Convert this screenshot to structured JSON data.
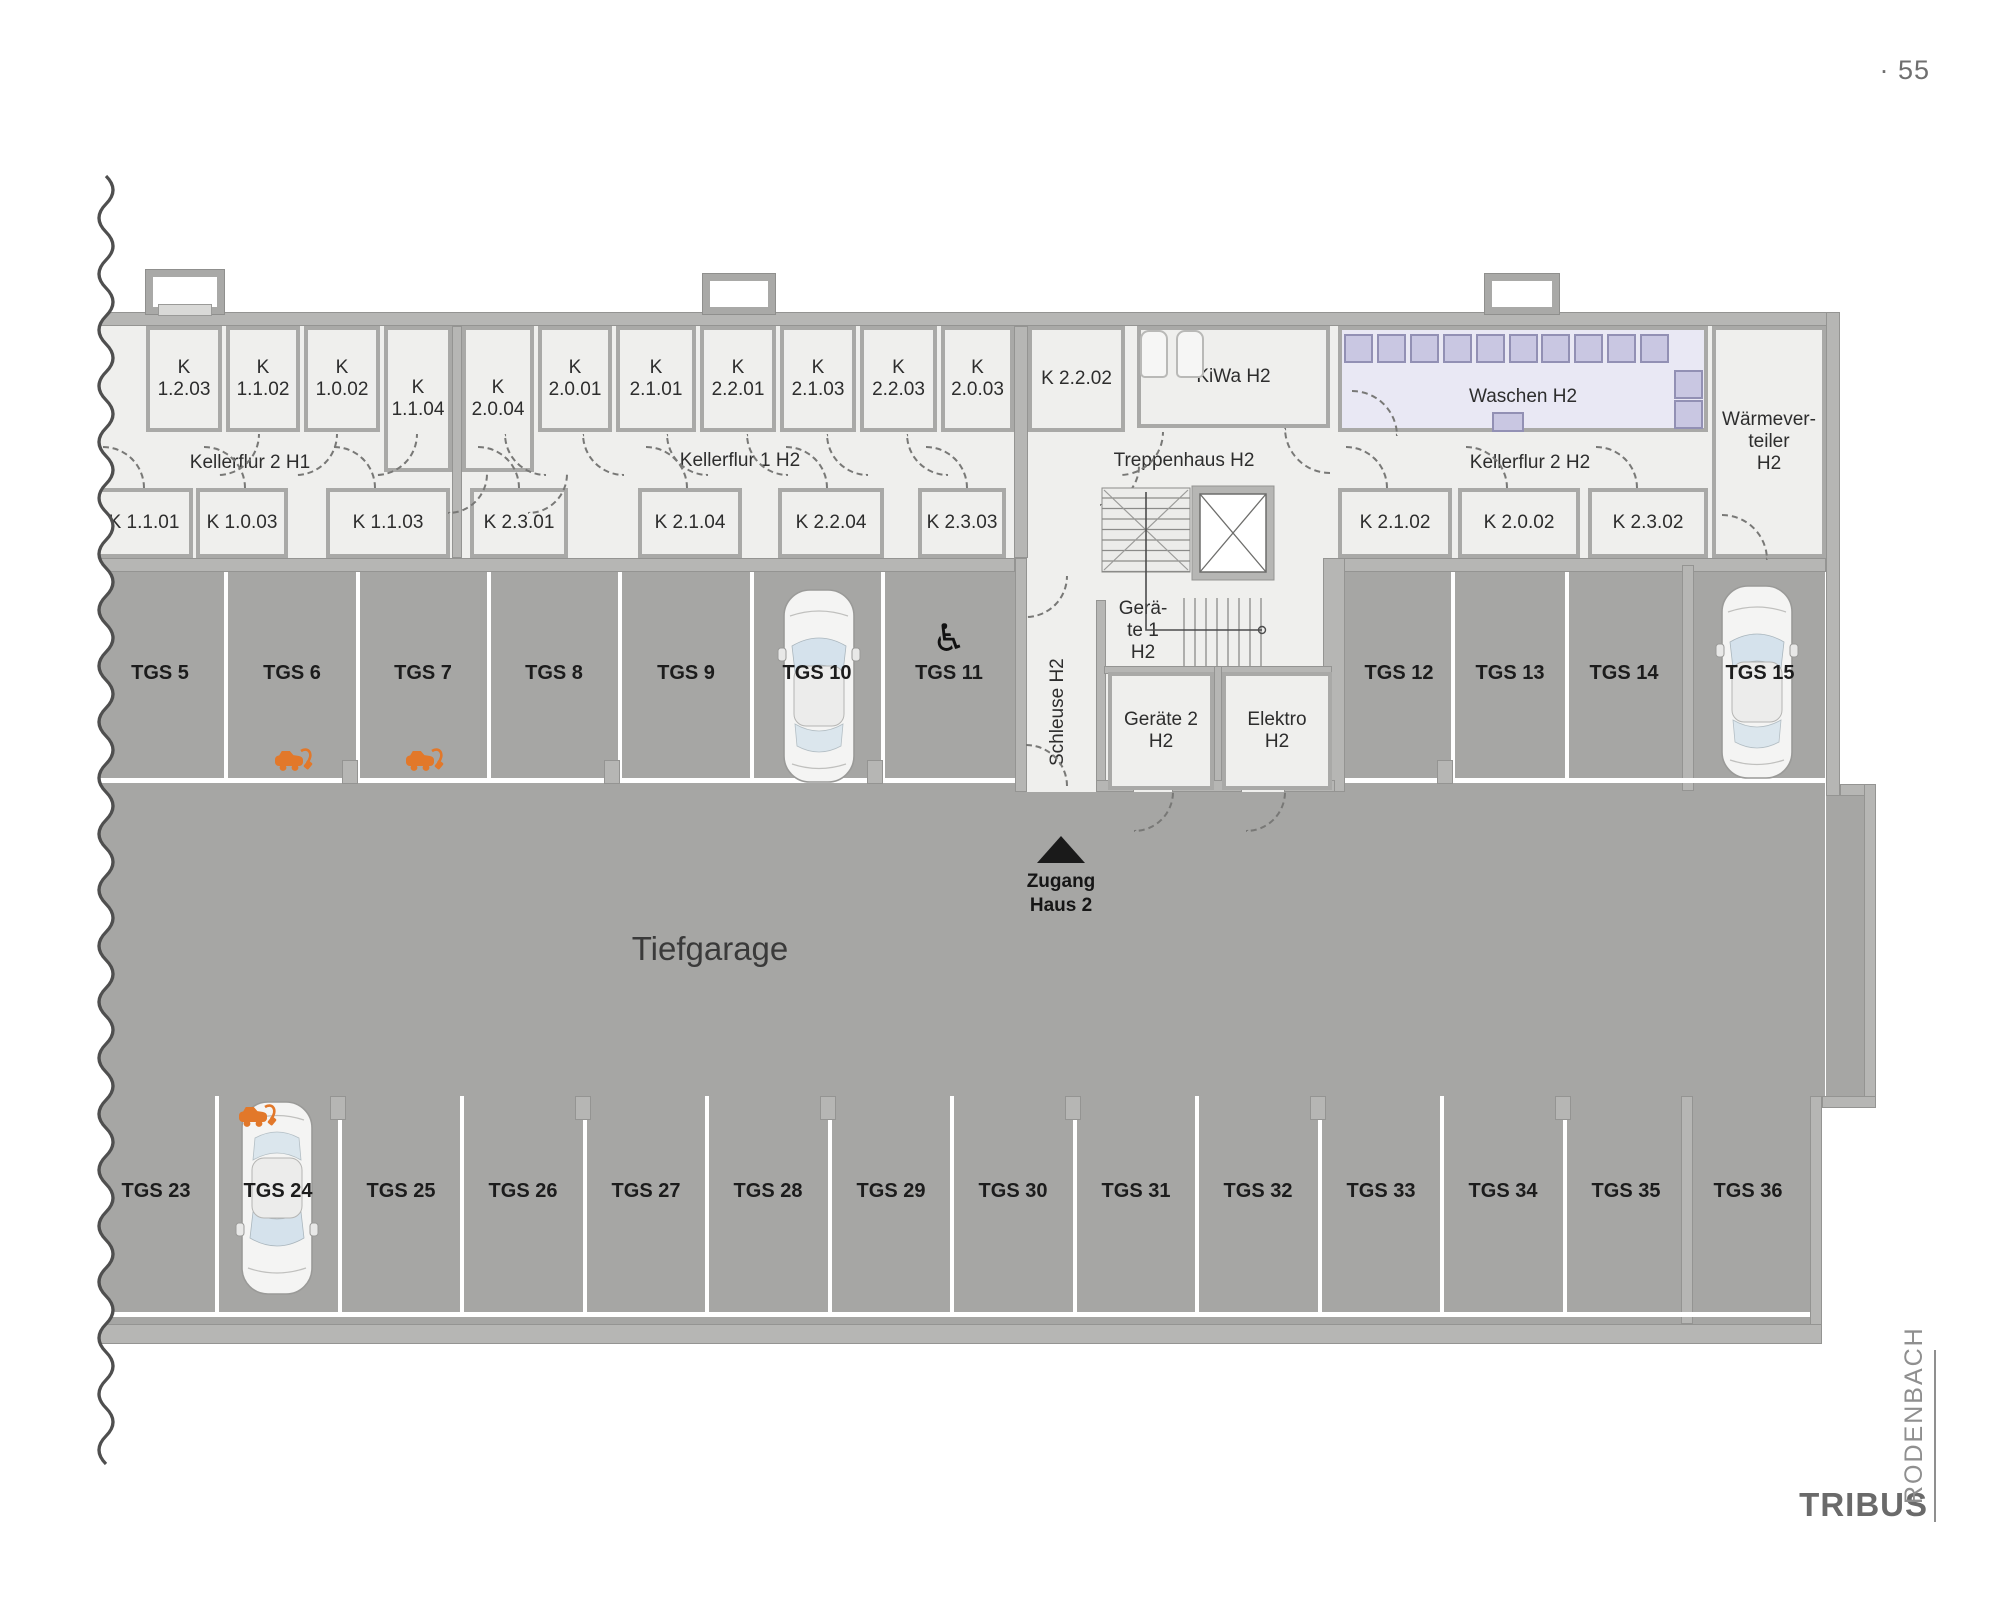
{
  "page": {
    "number": "· 55"
  },
  "logo": {
    "primary": "TRIBUS",
    "secondary": "RODENBACH"
  },
  "texts": {
    "garage": "Tiefgarage",
    "access_1": "Zugang",
    "access_2": "Haus 2"
  },
  "corridor_labels": [
    {
      "id": "kellerflur-2-h1",
      "t": "Kellerflur 2 H1",
      "x": 140,
      "y": 452,
      "w": 220
    },
    {
      "id": "kellerflur-1-h2",
      "t": "Kellerflur 1 H2",
      "x": 630,
      "y": 450,
      "w": 220
    },
    {
      "id": "treppenhaus-h2",
      "t": "Treppenhaus H2",
      "x": 1074,
      "y": 450,
      "w": 220
    },
    {
      "id": "kellerflur-2-h2",
      "t": "Kellerflur 2 H2",
      "x": 1420,
      "y": 452,
      "w": 220
    }
  ],
  "rooms": [
    {
      "id": "k-1-2-03",
      "lines": [
        "K",
        "1.2.03"
      ],
      "x": 146,
      "y": 326,
      "w": 76,
      "h": 106
    },
    {
      "id": "k-1-1-02",
      "lines": [
        "K",
        "1.1.02"
      ],
      "x": 226,
      "y": 326,
      "w": 74,
      "h": 106
    },
    {
      "id": "k-1-0-02",
      "lines": [
        "K",
        "1.0.02"
      ],
      "x": 304,
      "y": 326,
      "w": 76,
      "h": 106
    },
    {
      "id": "k-1-1-04",
      "lines": [
        "K",
        "1.1.04"
      ],
      "x": 384,
      "y": 326,
      "w": 68,
      "h": 146
    },
    {
      "id": "k-2-0-04",
      "lines": [
        "K",
        "2.0.04"
      ],
      "x": 462,
      "y": 326,
      "w": 72,
      "h": 146
    },
    {
      "id": "k-2-0-01",
      "lines": [
        "K",
        "2.0.01"
      ],
      "x": 538,
      "y": 326,
      "w": 74,
      "h": 106
    },
    {
      "id": "k-2-1-01",
      "lines": [
        "K",
        "2.1.01"
      ],
      "x": 616,
      "y": 326,
      "w": 80,
      "h": 106
    },
    {
      "id": "k-2-2-01",
      "lines": [
        "K",
        "2.2.01"
      ],
      "x": 700,
      "y": 326,
      "w": 76,
      "h": 106
    },
    {
      "id": "k-2-1-03",
      "lines": [
        "K",
        "2.1.03"
      ],
      "x": 780,
      "y": 326,
      "w": 76,
      "h": 106
    },
    {
      "id": "k-2-2-03",
      "lines": [
        "K",
        "2.2.03"
      ],
      "x": 860,
      "y": 326,
      "w": 77,
      "h": 106
    },
    {
      "id": "k-2-0-03",
      "lines": [
        "K",
        "2.0.03"
      ],
      "x": 941,
      "y": 326,
      "w": 73,
      "h": 106
    },
    {
      "id": "k-2-2-02",
      "lines": [
        "K 2.2.02"
      ],
      "x": 1028,
      "y": 326,
      "w": 97,
      "h": 106
    },
    {
      "id": "kiwa-h2",
      "lines": [
        "KiWa H2"
      ],
      "x": 1137,
      "y": 326,
      "w": 193,
      "h": 102
    },
    {
      "id": "waschen-h2",
      "cls": "wash",
      "lines": [
        "Waschen H2"
      ],
      "lpad": "36px 0 0 0",
      "x": 1338,
      "y": 326,
      "w": 370,
      "h": 106
    },
    {
      "id": "waermeverteiler-h2",
      "lines": [
        "Wärmever-",
        "teiler",
        "H2"
      ],
      "x": 1712,
      "y": 326,
      "w": 114,
      "h": 232
    },
    {
      "id": "k-1-1-01",
      "lines": [
        "K 1.1.01"
      ],
      "x": 95,
      "y": 488,
      "w": 98,
      "h": 70
    },
    {
      "id": "k-1-0-03",
      "lines": [
        "K 1.0.03"
      ],
      "x": 196,
      "y": 488,
      "w": 92,
      "h": 70
    },
    {
      "id": "k-1-1-03",
      "lines": [
        "K 1.1.03"
      ],
      "x": 326,
      "y": 488,
      "w": 124,
      "h": 70
    },
    {
      "id": "k-2-3-01",
      "lines": [
        "K 2.3.01"
      ],
      "x": 470,
      "y": 488,
      "w": 98,
      "h": 70
    },
    {
      "id": "k-2-1-04",
      "lines": [
        "K 2.1.04"
      ],
      "x": 638,
      "y": 488,
      "w": 104,
      "h": 70
    },
    {
      "id": "k-2-2-04",
      "lines": [
        "K 2.2.04"
      ],
      "x": 778,
      "y": 488,
      "w": 106,
      "h": 70
    },
    {
      "id": "k-2-3-03",
      "lines": [
        "K 2.3.03"
      ],
      "x": 918,
      "y": 488,
      "w": 88,
      "h": 70
    },
    {
      "id": "k-2-1-02",
      "lines": [
        "K 2.1.02"
      ],
      "x": 1338,
      "y": 488,
      "w": 114,
      "h": 70
    },
    {
      "id": "k-2-0-02",
      "lines": [
        "K 2.0.02"
      ],
      "x": 1458,
      "y": 488,
      "w": 122,
      "h": 70
    },
    {
      "id": "k-2-3-02",
      "lines": [
        "K 2.3.02"
      ],
      "x": 1588,
      "y": 488,
      "w": 120,
      "h": 70
    },
    {
      "id": "geraete-2-h2",
      "lines": [
        "Geräte 2",
        "H2"
      ],
      "x": 1108,
      "y": 672,
      "w": 106,
      "h": 118
    },
    {
      "id": "elektro-h2",
      "lines": [
        "Elektro",
        "H2"
      ],
      "x": 1222,
      "y": 672,
      "w": 110,
      "h": 118
    }
  ],
  "tech_labels": [
    {
      "id": "schleuse-h2",
      "lines": [
        "Schleuse H2"
      ],
      "x": 1044,
      "y": 630,
      "w": 28,
      "h": 164,
      "vertical": true
    },
    {
      "id": "geraete-1-h2",
      "lines": [
        "Gerä-",
        "te 1",
        "H2"
      ],
      "x": 1108,
      "y": 598,
      "w": 70,
      "h": 66
    }
  ],
  "parking": {
    "top": {
      "label_y": 662,
      "cells": [
        {
          "t": "TGS 5",
          "cx": 160,
          "x1": 95,
          "x2": 226
        },
        {
          "t": "TGS 6",
          "cx": 292,
          "x1": 226,
          "x2": 358
        },
        {
          "t": "TGS 7",
          "cx": 423,
          "x1": 358,
          "x2": 489
        },
        {
          "t": "TGS 8",
          "cx": 554,
          "x1": 489,
          "x2": 620
        },
        {
          "t": "TGS 9",
          "cx": 686,
          "x1": 620,
          "x2": 752
        },
        {
          "t": "TGS 10",
          "cx": 817,
          "x1": 752,
          "x2": 883
        },
        {
          "t": "TGS 11",
          "cx": 949,
          "x1": 883,
          "x2": 1015
        },
        {
          "t": "TGS 12",
          "cx": 1399,
          "x1": 1345,
          "x2": 1453
        },
        {
          "t": "TGS 13",
          "cx": 1510,
          "x1": 1453,
          "x2": 1567
        },
        {
          "t": "TGS 14",
          "cx": 1624,
          "x1": 1567,
          "x2": 1682
        },
        {
          "t": "TGS 15",
          "cx": 1760,
          "x1": 1694,
          "x2": 1826
        }
      ]
    },
    "bottom": {
      "label_y": 1180,
      "cells": [
        {
          "t": "TGS 23",
          "cx": 156,
          "x1": 95,
          "x2": 217
        },
        {
          "t": "TGS 24",
          "cx": 278,
          "x1": 217,
          "x2": 340
        },
        {
          "t": "TGS 25",
          "cx": 401,
          "x1": 340,
          "x2": 462
        },
        {
          "t": "TGS 26",
          "cx": 523,
          "x1": 462,
          "x2": 585
        },
        {
          "t": "TGS 27",
          "cx": 646,
          "x1": 585,
          "x2": 707
        },
        {
          "t": "TGS 28",
          "cx": 768,
          "x1": 707,
          "x2": 830
        },
        {
          "t": "TGS 29",
          "cx": 891,
          "x1": 830,
          "x2": 952
        },
        {
          "t": "TGS 30",
          "cx": 1013,
          "x1": 952,
          "x2": 1075
        },
        {
          "t": "TGS 31",
          "cx": 1136,
          "x1": 1075,
          "x2": 1197
        },
        {
          "t": "TGS 32",
          "cx": 1258,
          "x1": 1197,
          "x2": 1320
        },
        {
          "t": "TGS 33",
          "cx": 1381,
          "x1": 1320,
          "x2": 1442
        },
        {
          "t": "TGS 34",
          "cx": 1503,
          "x1": 1442,
          "x2": 1565
        },
        {
          "t": "TGS 35",
          "cx": 1626,
          "x1": 1565,
          "x2": 1687
        },
        {
          "t": "TGS 36",
          "cx": 1748,
          "x1": 1687,
          "x2": 1810
        }
      ]
    }
  },
  "features": {
    "cars": [
      {
        "x": 778,
        "y": 586,
        "flip": false
      },
      {
        "x": 1716,
        "y": 582,
        "flip": false
      },
      {
        "x": 236,
        "y": 1098,
        "flip": true
      }
    ],
    "ev": [
      {
        "x": 292,
        "y": 760
      },
      {
        "x": 423,
        "y": 760
      },
      {
        "x": 256,
        "y": 1116
      }
    ],
    "wheelchair": {
      "glyph": "♿",
      "x": 949,
      "y": 616
    },
    "washers_top": {
      "x0": 1344,
      "y": 334,
      "n": 10,
      "step": 32.9,
      "size": 29
    },
    "washers_side": [
      {
        "x": 1674,
        "y": 370
      },
      {
        "x": 1674,
        "y": 400
      }
    ],
    "sink": {
      "x": 1492,
      "y": 412,
      "w": 28,
      "h": 16
    },
    "strollers": [
      {
        "x": 1140,
        "y": 330
      },
      {
        "x": 1176,
        "y": 330
      }
    ]
  },
  "layout": {
    "garage": [
      [
        85,
        572,
        1740,
        752
      ],
      [
        1826,
        796,
        40,
        300
      ]
    ],
    "white_patches": [
      [
        1822,
        1108,
        186,
        248
      ]
    ],
    "floors": [
      [
        85,
        326,
        1741,
        232
      ],
      [
        1015,
        558,
        320,
        234
      ]
    ],
    "walls": [
      [
        85,
        312,
        1755,
        14
      ],
      [
        1826,
        312,
        14,
        484
      ],
      [
        1840,
        784,
        36,
        12
      ],
      [
        1864,
        784,
        12,
        324
      ],
      [
        1822,
        1096,
        54,
        12
      ],
      [
        1810,
        1096,
        12,
        240
      ],
      [
        85,
        1324,
        1737,
        20
      ],
      [
        85,
        558,
        930,
        14
      ],
      [
        1335,
        558,
        491,
        14
      ],
      [
        1015,
        558,
        12,
        234
      ],
      [
        1323,
        558,
        22,
        234
      ],
      [
        1096,
        600,
        10,
        192
      ],
      [
        1104,
        666,
        122,
        8
      ],
      [
        1218,
        666,
        114,
        8
      ],
      [
        1214,
        666,
        8,
        126
      ],
      [
        1096,
        780,
        38,
        12
      ],
      [
        1172,
        780,
        70,
        12
      ],
      [
        1284,
        780,
        51,
        12
      ],
      [
        452,
        326,
        10,
        232
      ],
      [
        1014,
        326,
        14,
        232
      ],
      [
        1682,
        565,
        12,
        226
      ],
      [
        1681,
        1096,
        12,
        228
      ]
    ],
    "lightwells": [
      [
        146,
        270,
        78,
        44
      ],
      [
        703,
        274,
        72,
        40
      ],
      [
        1485,
        274,
        74,
        40
      ]
    ],
    "white_lines": [
      [
        224,
        572,
        4,
        208
      ],
      [
        356,
        572,
        4,
        208
      ],
      [
        487,
        572,
        4,
        208
      ],
      [
        618,
        572,
        4,
        208
      ],
      [
        750,
        572,
        4,
        208
      ],
      [
        881,
        572,
        4,
        208
      ],
      [
        1451,
        572,
        4,
        208
      ],
      [
        1565,
        572,
        4,
        208
      ],
      [
        95,
        778,
        920,
        5
      ],
      [
        1345,
        778,
        481,
        5
      ],
      [
        215,
        1096,
        4,
        220
      ],
      [
        338,
        1096,
        4,
        220
      ],
      [
        460,
        1096,
        4,
        220
      ],
      [
        583,
        1096,
        4,
        220
      ],
      [
        705,
        1096,
        4,
        220
      ],
      [
        828,
        1096,
        4,
        220
      ],
      [
        950,
        1096,
        4,
        220
      ],
      [
        1073,
        1096,
        4,
        220
      ],
      [
        1195,
        1096,
        4,
        220
      ],
      [
        1318,
        1096,
        4,
        220
      ],
      [
        1440,
        1096,
        4,
        220
      ],
      [
        1563,
        1096,
        4,
        220
      ],
      [
        95,
        1312,
        1715,
        5
      ]
    ],
    "pillars": [
      [
        342,
        760
      ],
      [
        604,
        760
      ],
      [
        867,
        760
      ],
      [
        1437,
        760
      ],
      [
        330,
        1096
      ],
      [
        575,
        1096
      ],
      [
        820,
        1096
      ],
      [
        1065,
        1096
      ],
      [
        1310,
        1096
      ],
      [
        1555,
        1096
      ]
    ],
    "doors": [
      [
        218,
        434,
        40,
        "tl"
      ],
      [
        296,
        434,
        40,
        "tl"
      ],
      [
        376,
        434,
        40,
        "tl"
      ],
      [
        448,
        474,
        38,
        "tl"
      ],
      [
        528,
        474,
        38,
        "tl"
      ],
      [
        504,
        434,
        40,
        "tr"
      ],
      [
        582,
        434,
        40,
        "tr"
      ],
      [
        666,
        434,
        40,
        "tr"
      ],
      [
        746,
        434,
        40,
        "tr"
      ],
      [
        826,
        434,
        40,
        "tr"
      ],
      [
        906,
        434,
        40,
        "tr"
      ],
      [
        1120,
        432,
        42,
        "tl"
      ],
      [
        1284,
        428,
        44,
        "tr"
      ],
      [
        103,
        446,
        40,
        "bl"
      ],
      [
        204,
        446,
        40,
        "bl"
      ],
      [
        334,
        446,
        40,
        "bl"
      ],
      [
        478,
        446,
        40,
        "bl"
      ],
      [
        646,
        446,
        40,
        "bl"
      ],
      [
        786,
        446,
        40,
        "bl"
      ],
      [
        926,
        446,
        40,
        "bl"
      ],
      [
        1346,
        446,
        40,
        "bl"
      ],
      [
        1466,
        446,
        40,
        "bl"
      ],
      [
        1596,
        446,
        40,
        "bl"
      ],
      [
        1352,
        390,
        44,
        "bl"
      ],
      [
        1722,
        514,
        44,
        "bl"
      ],
      [
        1026,
        576,
        40,
        "tl"
      ],
      [
        1026,
        744,
        40,
        "bl"
      ],
      [
        1134,
        792,
        38,
        "tl"
      ],
      [
        1246,
        792,
        38,
        "tl"
      ],
      [
        1100,
        466,
        38,
        "tl"
      ]
    ],
    "stairs_upper": [
      1102,
      488,
      88,
      84
    ],
    "stairs_lower": [
      1176,
      598,
      90,
      68
    ],
    "elevator": [
      1192,
      486,
      82,
      94
    ],
    "guide": [
      1146,
      492,
      1146,
      630,
      1262,
      630
    ],
    "wave": {
      "x": 106,
      "y0": 176,
      "y1": 1462,
      "amp": 14,
      "step": 28
    }
  }
}
